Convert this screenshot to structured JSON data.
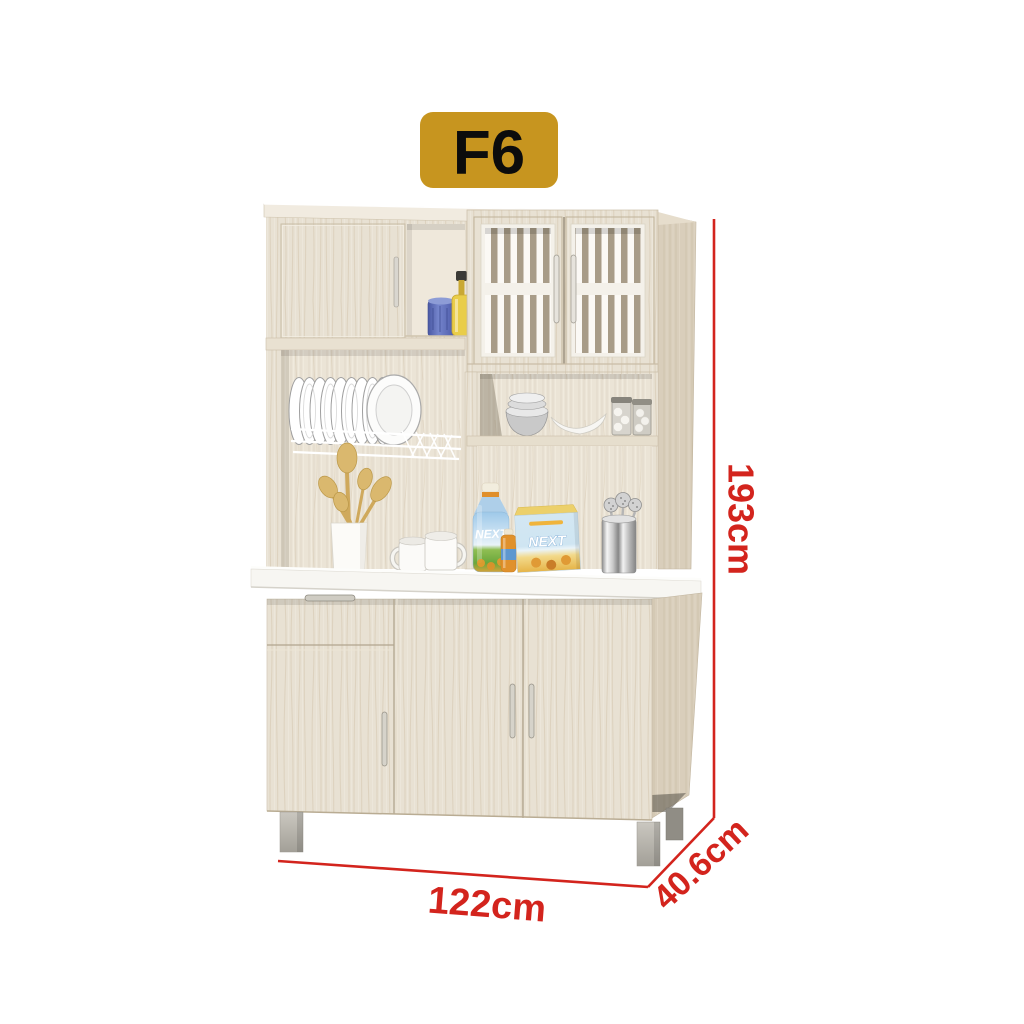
{
  "badge": {
    "label": "F6"
  },
  "dimensions": {
    "height_label": "193cm",
    "width_label": "122cm",
    "depth_label": "40.6cm"
  },
  "products": {
    "bottle_brand": "NEXT",
    "box_brand": "NEXT"
  },
  "colors": {
    "dimension_red": "#d3241d",
    "badge_gold": "#c7951f",
    "badge_text": "#0c0c0c",
    "wood_front": "#e8e1d3",
    "wood_side": "#d9cebb",
    "counter_white": "#f7f6f2",
    "background": "#ffffff"
  }
}
